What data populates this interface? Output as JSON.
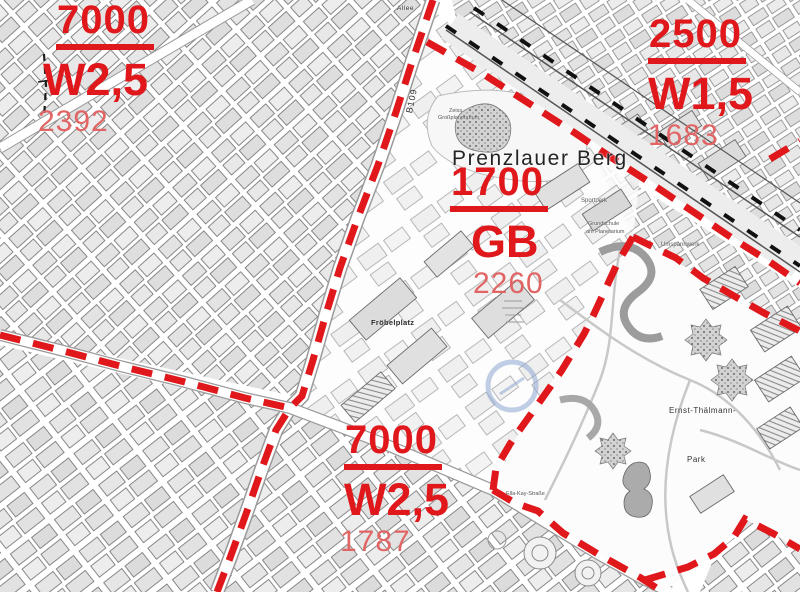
{
  "colors": {
    "boundary_red": "#e0181c",
    "zone_value_red": "#e0181c",
    "zone_indicative_red": "#e16565",
    "district_text": "#242424"
  },
  "district_label": {
    "text": "Prenzlauer Berg"
  },
  "zones": [
    {
      "id": "top-left",
      "value": "7000",
      "type_code": "W2,5",
      "indicative_value": "2392"
    },
    {
      "id": "top-right",
      "value": "2500",
      "type_code": "W1,5",
      "indicative_value": "1683"
    },
    {
      "id": "center",
      "value": "1700",
      "type_code": "GB",
      "indicative_value": "2260"
    },
    {
      "id": "bottom-center",
      "value": "7000",
      "type_code": "W2,5",
      "indicative_value": "1787"
    }
  ],
  "map_labels": [
    {
      "text": "Allee",
      "x": 397,
      "y": 5,
      "size": 6.5,
      "weight": 400,
      "rot": 0,
      "color": "#333333",
      "spacing": 0.5
    },
    {
      "text": "B109",
      "x": 404,
      "y": 112,
      "size": 9,
      "weight": 400,
      "rot": -78,
      "color": "#333333",
      "spacing": 1
    },
    {
      "text": "Zeiss",
      "x": 449,
      "y": 108,
      "size": 5.5,
      "weight": 400,
      "rot": 0,
      "color": "#555555",
      "spacing": 0
    },
    {
      "text": "Großplanetarium",
      "x": 438,
      "y": 115,
      "size": 5.5,
      "weight": 400,
      "rot": 0,
      "color": "#555555",
      "spacing": 0
    },
    {
      "text": "Sportpark",
      "x": 581,
      "y": 198,
      "size": 6,
      "weight": 400,
      "rot": 0,
      "color": "#555555",
      "spacing": 0
    },
    {
      "text": "Grundschule",
      "x": 588,
      "y": 221,
      "size": 5.5,
      "weight": 400,
      "rot": 0,
      "color": "#555555",
      "spacing": 0
    },
    {
      "text": "am Planetarium",
      "x": 586,
      "y": 229,
      "size": 5.5,
      "weight": 400,
      "rot": 0,
      "color": "#555555",
      "spacing": 0
    },
    {
      "text": "Umspannwerk",
      "x": 661,
      "y": 242,
      "size": 6,
      "weight": 400,
      "rot": 0,
      "color": "#555555",
      "spacing": 0
    },
    {
      "text": "Fröbelplatz",
      "x": 371,
      "y": 318,
      "size": 7.5,
      "weight": 700,
      "rot": 0,
      "color": "#2a2a2a",
      "spacing": 0.3
    },
    {
      "text": "Ernst-Thälmann-",
      "x": 669,
      "y": 406,
      "size": 8,
      "weight": 400,
      "rot": 0,
      "color": "#333333",
      "spacing": 0.5
    },
    {
      "text": "Park",
      "x": 687,
      "y": 455,
      "size": 8,
      "weight": 400,
      "rot": 0,
      "color": "#333333",
      "spacing": 0.5
    },
    {
      "text": "Ella-Kay-Straße",
      "x": 506,
      "y": 491,
      "size": 5.5,
      "weight": 400,
      "rot": 0,
      "color": "#555555",
      "spacing": 0
    }
  ]
}
